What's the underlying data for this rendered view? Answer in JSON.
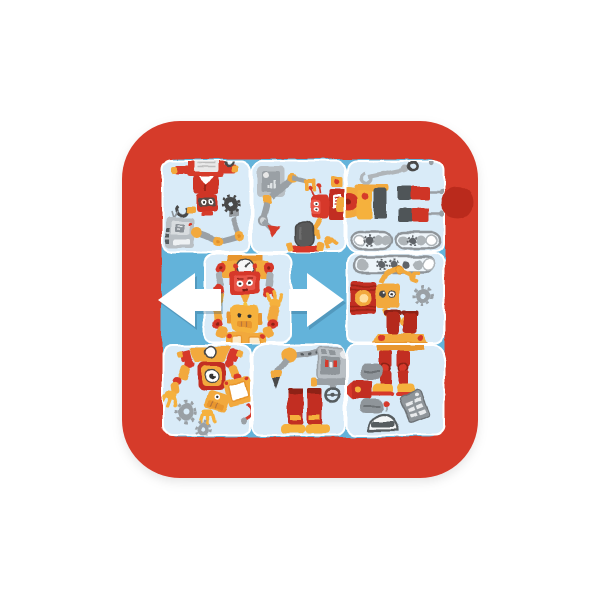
{
  "scene": {
    "label": "Robot sliding-tile puzzle in a red tray",
    "alt": "Square red plastic frame holding wavy-edged light blue puzzle tiles illustrated with cartoon robots and robot parts; the middle-row tile is shifted sideways with white left and right arrows showing it can slide."
  },
  "colors": {
    "background": "#ffffff",
    "frame_red": "#d63a2a",
    "notch_red": "#ba2b1d",
    "tray_blue": "#64b3da",
    "tile_blue": "#d9ebf8",
    "seam_white": "#ffffff",
    "arrow_white": "#ffffff",
    "robot_red": "#cf3526",
    "robot_orange": "#f2a93c",
    "metal_gray": "#9aa0a5",
    "dark_gray": "#4a4a4a"
  },
  "board": {
    "rows": 3,
    "cols": 3,
    "tile_count": 8,
    "empty_slots": 2
  },
  "tiles": [
    {
      "id": "tile-top-left",
      "row": 1,
      "col": 1,
      "description": "red and white robot head and chest with yellow winged arms, gray control box with antenna, jointed metal arm holding a dark gear"
    },
    {
      "id": "tile-top-middle",
      "row": 1,
      "col": 2,
      "description": "gray instrument box, articulated gray arm with red pointed tip and yellow gripper, sideways red robot with label chest, dark microphone on red stand"
    },
    {
      "id": "tile-top-right",
      "row": 1,
      "col": 3,
      "description": "gray wrench and bolt ring, robot boot blocks with pegs, orange and red disc at left edge, two roller conveyor tracks"
    },
    {
      "id": "tile-middle-center",
      "row": 2,
      "col": 2,
      "description": "orange gauge-topped head unit with red face and red gripper arms above a yellow robot raising both hands"
    },
    {
      "id": "tile-middle-right",
      "row": 2,
      "col": 3,
      "description": "roller conveyor, red lantern lamp beside an orange robot head with yellow gripper arms, gray gear, orange hip piece with upside-down red boots"
    },
    {
      "id": "tile-bottom-left",
      "row": 3,
      "col": 1,
      "description": "one-eyed red and orange robot with yellow gripper hands, tipped-over robot with white screen body and red cable, two gray gears"
    },
    {
      "id": "tile-bottom-middle",
      "row": 3,
      "col": 2,
      "description": "robot arm with drill bit, gray control panel with steering wheel, two red cylinder legs with yellow feet"
    },
    {
      "id": "tile-bottom-right",
      "row": 3,
      "col": 3,
      "description": "red robot legs with yellow boots, sideways red torso with gray pads and nose cone, tilted gray keypad, gray dome helmet"
    }
  ],
  "empty_slots": [
    {
      "id": "slot-middle-left",
      "row": 2,
      "position": "left of shifted tile"
    },
    {
      "id": "slot-middle-right",
      "row": 2,
      "position": "right of shifted tile"
    }
  ],
  "arrows": [
    {
      "id": "arrow-left",
      "direction": "left"
    },
    {
      "id": "arrow-right",
      "direction": "right"
    }
  ]
}
